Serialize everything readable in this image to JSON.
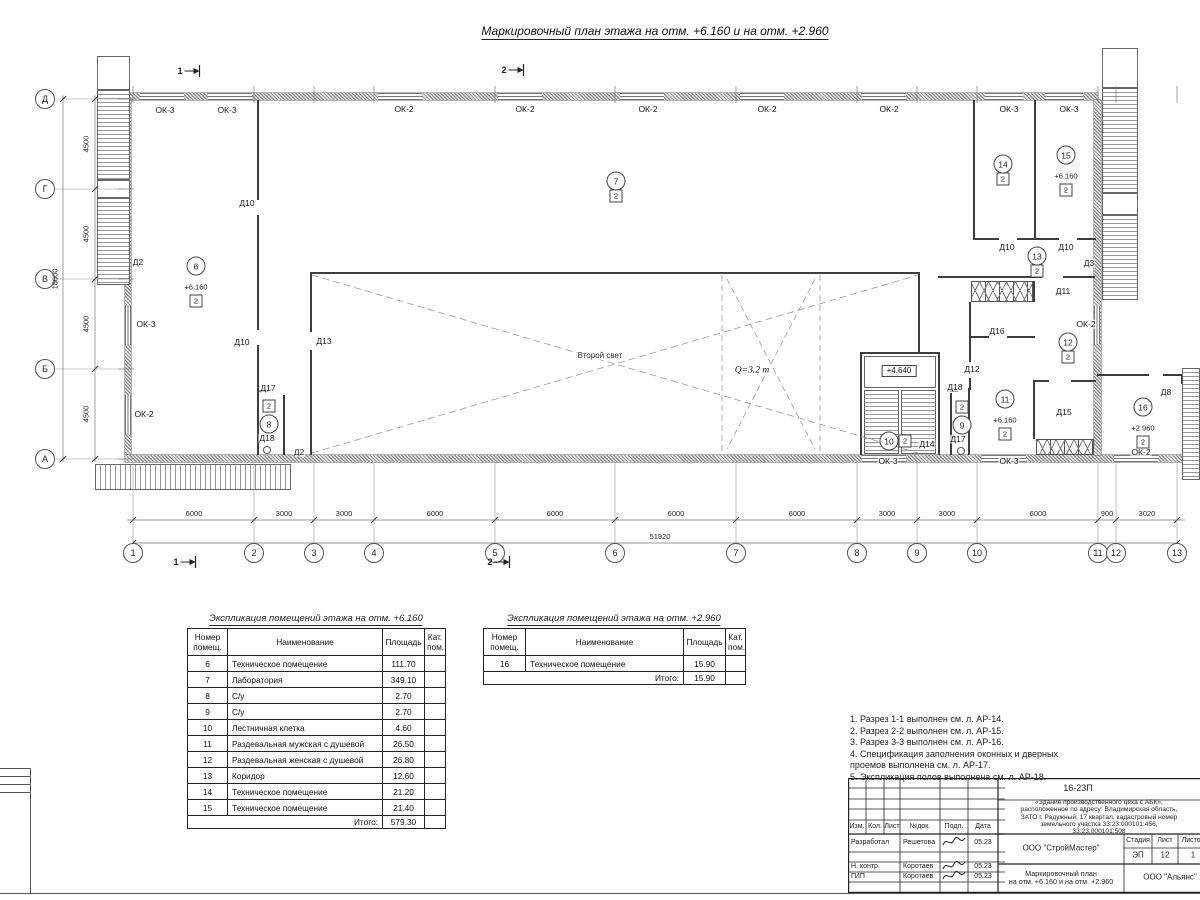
{
  "sheet": {
    "title": "Маркировочный план этажа на отм. +6.160 и на отм. +2.960"
  },
  "plan": {
    "axes_h": [
      "1",
      "2",
      "3",
      "4",
      "5",
      "6",
      "7",
      "8",
      "9",
      "10",
      "11",
      "12",
      "13"
    ],
    "dims_h": [
      "6000",
      "3000",
      "3000",
      "6000",
      "6000",
      "6000",
      "6000",
      "3000",
      "3000",
      "6000",
      "900",
      "3020"
    ],
    "dim_h_total": "51920",
    "axes_v": [
      "Д",
      "Г",
      "В",
      "Б",
      "А"
    ],
    "dims_v": [
      "4500",
      "4500",
      "4500",
      "4500"
    ],
    "dim_v_total": "18000",
    "section_marks": [
      {
        "t": "1",
        "x": 190,
        "y": 71
      },
      {
        "t": "2",
        "x": 514,
        "y": 70
      },
      {
        "t": "1",
        "x": 186,
        "y": 562
      },
      {
        "t": "2",
        "x": 500,
        "y": 562
      }
    ],
    "labels": [
      {
        "t": "ОК-3",
        "x": 165,
        "y": 110
      },
      {
        "t": "ОК-3",
        "x": 227,
        "y": 110
      },
      {
        "t": "ОК-2",
        "x": 404,
        "y": 109
      },
      {
        "t": "ОК-2",
        "x": 525,
        "y": 109
      },
      {
        "t": "ОК-2",
        "x": 648,
        "y": 109
      },
      {
        "t": "ОК-2",
        "x": 767,
        "y": 109
      },
      {
        "t": "ОК-2",
        "x": 889,
        "y": 109
      },
      {
        "t": "ОК-3",
        "x": 1009,
        "y": 109
      },
      {
        "t": "ОК-3",
        "x": 1069,
        "y": 109
      },
      {
        "t": "ОК-3",
        "x": 146,
        "y": 324
      },
      {
        "t": "ОК-2",
        "x": 144,
        "y": 414
      },
      {
        "t": "ОК-3",
        "x": 888,
        "y": 461
      },
      {
        "t": "ОК-3",
        "x": 1009,
        "y": 461
      },
      {
        "t": "ОК-2",
        "x": 1141,
        "y": 452
      },
      {
        "t": "ОК-2",
        "x": 1086,
        "y": 324
      },
      {
        "t": "Д2",
        "x": 138,
        "y": 262
      },
      {
        "t": "Д2",
        "x": 299,
        "y": 452
      },
      {
        "t": "Д10",
        "x": 247,
        "y": 203
      },
      {
        "t": "Д10",
        "x": 242,
        "y": 342
      },
      {
        "t": "Д13",
        "x": 324,
        "y": 341
      },
      {
        "t": "Д17",
        "x": 268,
        "y": 388
      },
      {
        "t": "Д18",
        "x": 267,
        "y": 438
      },
      {
        "t": "Д18",
        "x": 955,
        "y": 387
      },
      {
        "t": "Д17",
        "x": 958,
        "y": 439
      },
      {
        "t": "Д14",
        "x": 927,
        "y": 444
      },
      {
        "t": "Д12",
        "x": 972,
        "y": 369
      },
      {
        "t": "Д16",
        "x": 997,
        "y": 331
      },
      {
        "t": "Д15",
        "x": 1064,
        "y": 412
      },
      {
        "t": "Д11",
        "x": 1063,
        "y": 291
      },
      {
        "t": "Д10",
        "x": 1007,
        "y": 247
      },
      {
        "t": "Д10",
        "x": 1066,
        "y": 247
      },
      {
        "t": "Д3",
        "x": 1089,
        "y": 263
      },
      {
        "t": "Д8",
        "x": 1166,
        "y": 392
      },
      {
        "t": "Второй свет",
        "x": 600,
        "y": 356,
        "cls": "ann"
      },
      {
        "t": "Q=3.2 т",
        "x": 752,
        "y": 371,
        "cls": "crane"
      },
      {
        "t": "+4.640",
        "x": 899,
        "y": 371,
        "cls": "boxed"
      }
    ],
    "rooms": [
      {
        "num": "6",
        "elev": "+6.160",
        "cat": "2",
        "x": 196,
        "y": 266,
        "catpos": "below"
      },
      {
        "num": "7",
        "cat": "2",
        "x": 616,
        "y": 181,
        "catpos": "below"
      },
      {
        "num": "8",
        "cat": "2",
        "x": 269,
        "y": 424,
        "catpos": "above"
      },
      {
        "num": "9",
        "cat": "2",
        "x": 962,
        "y": 425,
        "catpos": "above"
      },
      {
        "num": "10",
        "cat": "2",
        "x": 889,
        "y": 441,
        "catpos": "right"
      },
      {
        "num": "11",
        "elev": "+6.160",
        "cat": "2",
        "x": 1005,
        "y": 399,
        "catpos": "below"
      },
      {
        "num": "12",
        "cat": "2",
        "x": 1068,
        "y": 342,
        "catpos": "below"
      },
      {
        "num": "13",
        "cat": "2",
        "x": 1037,
        "y": 256,
        "catpos": "below"
      },
      {
        "num": "14",
        "cat": "2",
        "x": 1003,
        "y": 164,
        "catpos": "below"
      },
      {
        "num": "15",
        "elev": "+6.160",
        "cat": "2",
        "x": 1066,
        "y": 155,
        "catpos": "below"
      },
      {
        "num": "16",
        "elev": "+2.960",
        "cat": "2",
        "x": 1143,
        "y": 407,
        "catpos": "below"
      }
    ]
  },
  "tables": [
    {
      "title": "Экспликация помещений этажа на отм. +6.160",
      "headers": [
        "Номер помещ.",
        "Наименование",
        "Площадь",
        "Кат. пом."
      ],
      "rows": [
        [
          "6",
          "Техническое помещение",
          "111.70",
          ""
        ],
        [
          "7",
          "Лаборатория",
          "349.10",
          ""
        ],
        [
          "8",
          "С/у",
          "2.70",
          ""
        ],
        [
          "9",
          "С/у",
          "2.70",
          ""
        ],
        [
          "10",
          "Лестничная клетка",
          "4.60",
          ""
        ],
        [
          "11",
          "Раздевальная мужская с душевой",
          "26.50",
          ""
        ],
        [
          "12",
          "Раздевальная женская с душевой",
          "26.80",
          ""
        ],
        [
          "13",
          "Коридор",
          "12.60",
          ""
        ],
        [
          "14",
          "Техническое помещение",
          "21.20",
          ""
        ],
        [
          "15",
          "Техническое помещение",
          "21.40",
          ""
        ]
      ],
      "total_label": "Итого:",
      "total_value": "579.30"
    },
    {
      "title": "Экспликация помещений этажа на отм. +2.960",
      "headers": [
        "Номер помещ.",
        "Наименование",
        "Площадь",
        "Кат. пом."
      ],
      "rows": [
        [
          "16",
          "Техническое помещение",
          "15.90",
          ""
        ]
      ],
      "total_label": "Итого:",
      "total_value": "15.90"
    }
  ],
  "notes": [
    "1. Разрез 1-1 выполнен см. л. АР-14.",
    "2. Разрез 2-2 выполнен см. л. АР-15.",
    "3. Разрез 3-3 выполнен см. л. АР-16.",
    "4. Спецификация заполнения оконных и дверных\n    проемов выполнена см. л. АР-17.",
    "5. Экспликация полов выполнена см. л. АР-18."
  ],
  "stamp": {
    "doc_number": "16-23П",
    "project_desc": "«Здание производственного цеха с АБК»,\nрасположенное по адресу: Владимирская область,\nЗАТО г. Радужный, 17 квартал, кадастровый номер\nземельного участка 33:23:000101:456, 33:23:000101:508",
    "header_cols": [
      "Изм.",
      "Кол.",
      "Лист",
      "№док.",
      "Подл.",
      "Дата"
    ],
    "roles": [
      {
        "role": "Разработал",
        "name": "Решетова",
        "date": "05.23"
      },
      {
        "role": "Н. контр.",
        "name": "Коротаев",
        "date": "05.23"
      },
      {
        "role": "ГИП",
        "name": "Коротаев",
        "date": "05.23"
      }
    ],
    "org1": "ООО \"СтройМастер\"",
    "stage_label": "Стадия",
    "sheet_label": "Лист",
    "sheets_label": "Листов",
    "stage": "ЭП",
    "sheet": "12",
    "sheets": "1",
    "drawing_name": "Маркировочный план\nна отм. +6.160 и на отм. +2.960",
    "org2": "ООО \"Альянс\""
  }
}
